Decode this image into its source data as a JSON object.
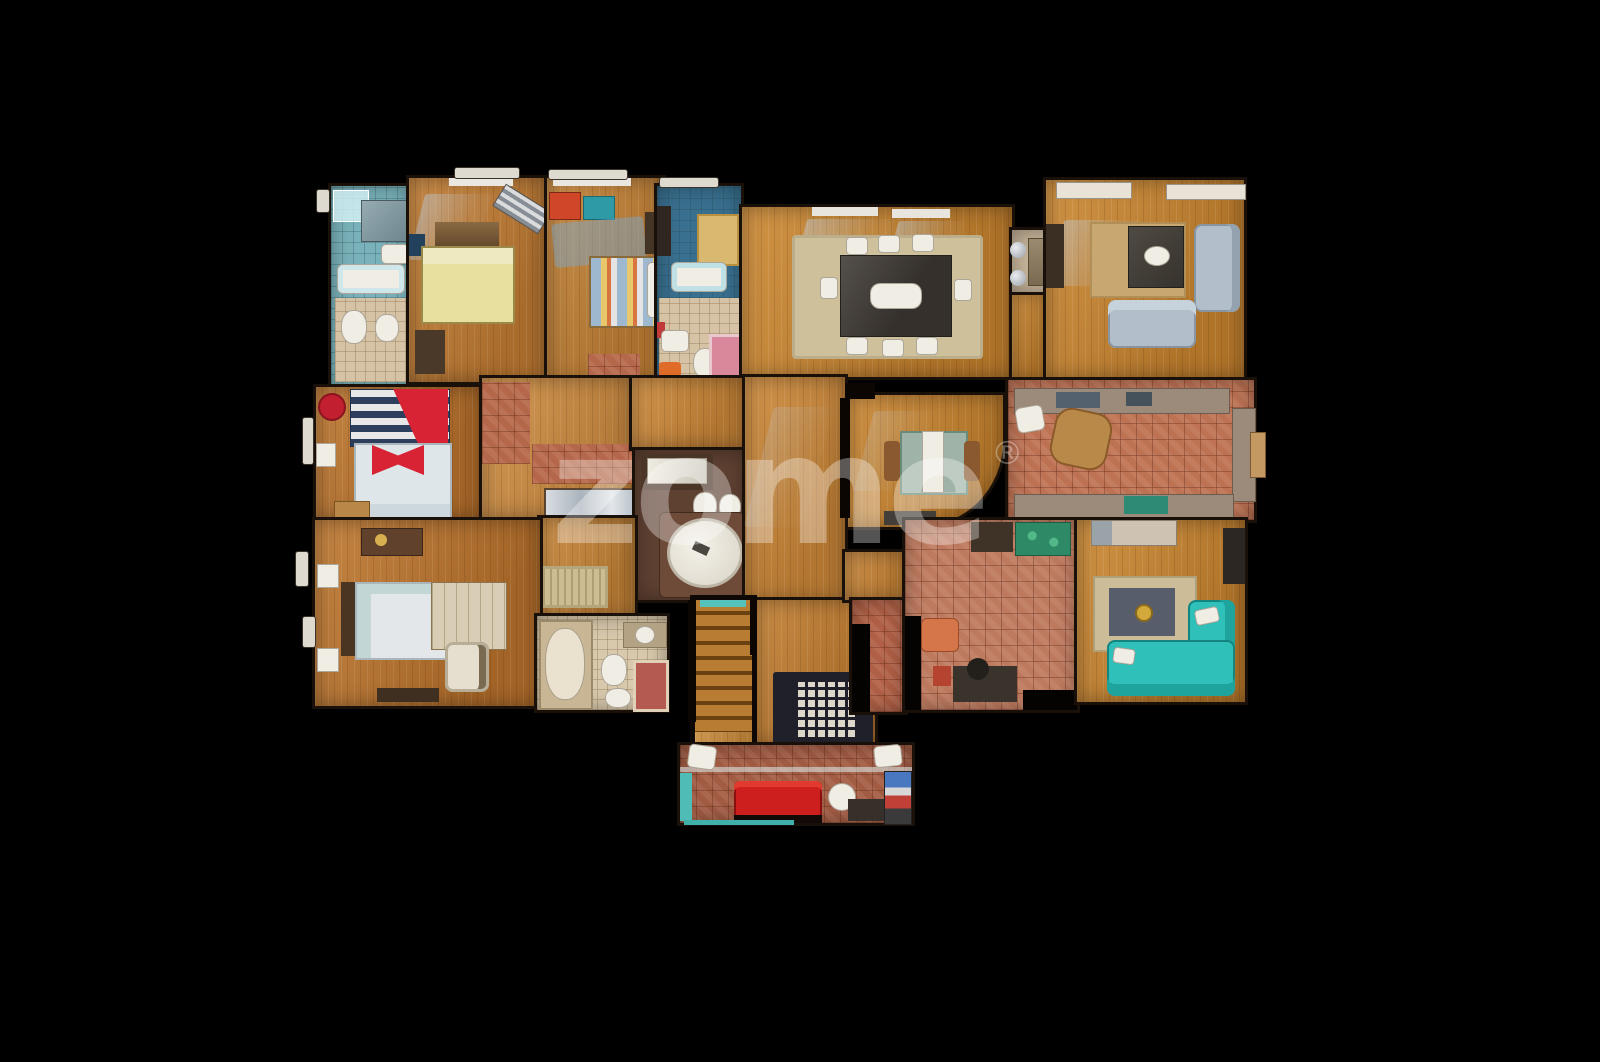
{
  "watermark": {
    "text": "zome",
    "registered": "®"
  },
  "scene": {
    "type": "floorplan-top-down-3d-scan",
    "background": "black",
    "rooms": [
      {
        "name": "bathroom-top-left",
        "floor": "teal-tile",
        "furniture": [
          "shower",
          "mirror",
          "sink",
          "bathtub",
          "toilet",
          "bidet"
        ]
      },
      {
        "name": "bedroom-yellow",
        "floor": "wood",
        "furniture": [
          "window",
          "tv",
          "headboard",
          "double-bed-yellow",
          "striped-lounger",
          "cabinet"
        ]
      },
      {
        "name": "bedroom-striped",
        "floor": "wood",
        "furniture": [
          "window",
          "desk-teal",
          "chair-red",
          "striped-bed",
          "wardrobe"
        ]
      },
      {
        "name": "bathroom-top-center",
        "floor": "blue-tile",
        "furniture": [
          "rug-tan",
          "bathtub",
          "sink",
          "toilet",
          "rug-pink"
        ]
      },
      {
        "name": "dining-room",
        "floor": "wood",
        "furniture": [
          "windows",
          "area-rug",
          "glass-dining-table",
          "chairs"
        ]
      },
      {
        "name": "bar-nook",
        "floor": "stone",
        "furniture": [
          "high-counter",
          "chrome-stools"
        ]
      },
      {
        "name": "living-room",
        "floor": "wood",
        "furniture": [
          "consoles",
          "media-wall",
          "rug",
          "coffee-table",
          "sofa-gray",
          "loveseat-gray"
        ]
      },
      {
        "name": "bedroom-red",
        "floor": "wood",
        "furniture": [
          "pouf-red",
          "striped-headboard",
          "red-blanket",
          "bed",
          "nightstand",
          "bench"
        ]
      },
      {
        "name": "hallway-upper",
        "floor": "wood+terracotta",
        "furniture": [
          "mirror-closet"
        ]
      },
      {
        "name": "bathroom-center",
        "floor": "brown",
        "furniture": [
          "vanity",
          "toilet",
          "bidet",
          "round-jacuzzi"
        ]
      },
      {
        "name": "hallway-lower",
        "floor": "wood",
        "furniture": [
          "oriental-rug"
        ]
      },
      {
        "name": "breakfast-room",
        "floor": "wood-curved-wall",
        "furniture": [
          "table-white-runner",
          "chairs",
          "bench"
        ]
      },
      {
        "name": "kitchen",
        "floor": "terracotta-tile",
        "furniture": [
          "counter-top",
          "counter-right",
          "counter-bottom",
          "stove",
          "small-table",
          "chair"
        ]
      },
      {
        "name": "bedroom-bottom-left",
        "floor": "wood",
        "furniture": [
          "dresser",
          "nightstands",
          "bed",
          "wardrobe",
          "armchair",
          "bench"
        ]
      },
      {
        "name": "bathroom-bottom",
        "floor": "cream-tile",
        "furniture": [
          "shower",
          "sink",
          "toilet",
          "bidet",
          "rug-red"
        ]
      },
      {
        "name": "staircase",
        "floor": "wood-steps",
        "furniture": [
          "tread-mat"
        ]
      },
      {
        "name": "upper-hall-skylight",
        "floor": "wood",
        "furniture": [
          "glass-block-grid"
        ]
      },
      {
        "name": "entry-lounge",
        "floor": "terracotta-tile",
        "furniture": [
          "glass-partition",
          "red-sofa",
          "chairs",
          "desk",
          "shelf"
        ]
      },
      {
        "name": "family-room-tiled",
        "floor": "terracotta-tile",
        "furniture": [
          "fireplace",
          "plant-table",
          "orange-armchair",
          "office-desk"
        ]
      },
      {
        "name": "family-room-wood",
        "floor": "wood",
        "furniture": [
          "hutch",
          "tv",
          "rug-dark-center",
          "turquoise-corner-sofa"
        ]
      }
    ]
  },
  "palette": {
    "bg": "#000000",
    "wall": "#191009",
    "wood-mid": "#c8842f",
    "wood-warm": "#b9722c",
    "wood-light": "#cd8c42",
    "stair-wood": "#b87c33",
    "terracotta": "#b4674a",
    "terracotta-light": "#bd7a5f",
    "terracotta-dark": "#a25c44",
    "teal-bath": "#79b2ba",
    "blue-bath": "#39708f",
    "cream": "#d6c2a4",
    "fixture-white": "#f0ede5",
    "gray-sofa": "#b2bfca",
    "turquoise-sofa": "#2fc0b9",
    "red-sofa": "#ce1f1f",
    "red-bed": "#d82334",
    "yellow-bed": "#e7e09e",
    "rug-beige": "#cdbd92",
    "rug-dark": "#585d6b",
    "mat-navy": "#1f2029",
    "watermark": "rgba(255,255,255,0.33)"
  }
}
